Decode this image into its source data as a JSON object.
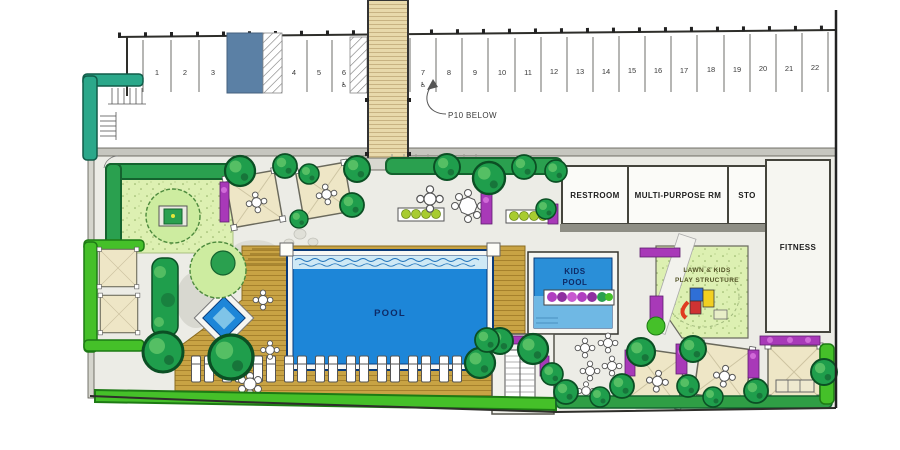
{
  "title": "Amenity Deck / Pool Level Site Plan",
  "parking": {
    "stalls": [
      "1",
      "2",
      "3",
      "4",
      "5",
      "6",
      "7",
      "8",
      "9",
      "10",
      "11",
      "12",
      "13",
      "14",
      "15",
      "16",
      "17",
      "18",
      "19",
      "20",
      "21",
      "22"
    ],
    "accessible_icon": "♿",
    "note": "P10 BELOW"
  },
  "rooms": {
    "restroom": "RESTROOM",
    "multi_purpose": "MULTI-PURPOSE RM",
    "storage": "STO",
    "fitness": "FITNESS"
  },
  "pool": {
    "label": "POOL"
  },
  "kids_pool": {
    "line1": "KIDS",
    "line2": "POOL"
  },
  "lawn": {
    "line1": "LAWN  &  KIDS",
    "line2": "PLAY STRUCTURE"
  },
  "colors": {
    "pool_blue": "#1d86d8",
    "kids_pool_blue": "#2a8fd8",
    "deck_wood": "#c8a344",
    "lawn_green": "#ddf0b2",
    "hedge_green": "#2aa04f",
    "bright_hedge": "#45c029",
    "teal_hedge": "#2ba88a",
    "flower_purple": "#a839b8",
    "reserved_stall_blue": "#5b80a5",
    "ramp_tan": "#e8d9ab",
    "cabana_tan": "#eee6c6"
  }
}
